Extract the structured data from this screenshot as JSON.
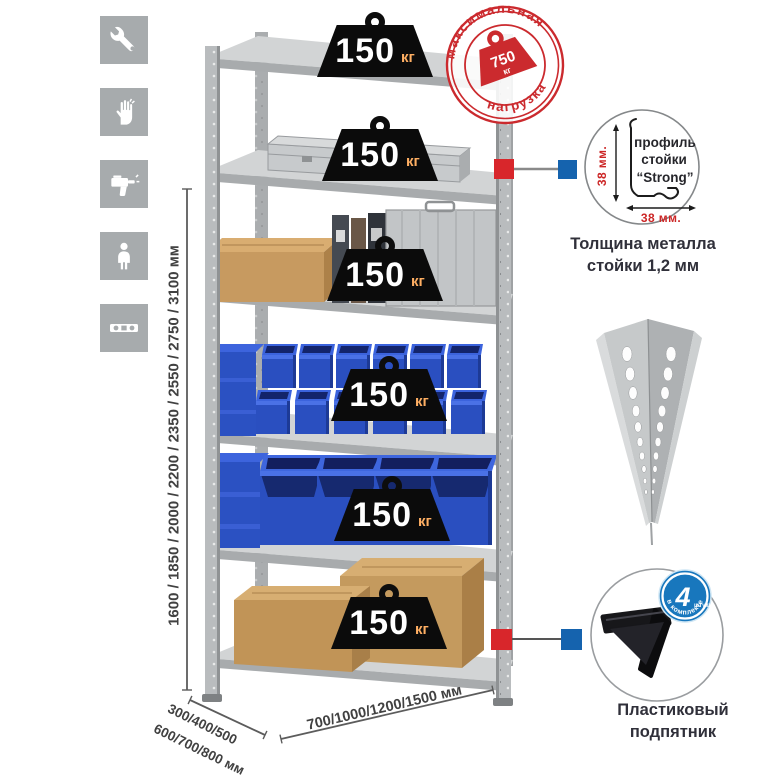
{
  "colors": {
    "stamp_red": "#cb2a2e",
    "connector_red": "#d8262b",
    "connector_blue": "#1563ae",
    "badge_blue": "#1877bd",
    "bin_blue": "#2a4fc0",
    "metal_grey": "#b9bcbe",
    "icon_grey": "#a7abad",
    "weight_black": "#0b0b0b"
  },
  "sidebar": {
    "icons": [
      {
        "name": "wrench-icon"
      },
      {
        "name": "gloves-icon"
      },
      {
        "name": "drill-icon"
      },
      {
        "name": "person-icon"
      },
      {
        "name": "level-icon"
      }
    ]
  },
  "rack": {
    "weights": {
      "unit": "кг",
      "items": [
        "150",
        "150",
        "150",
        "150",
        "150",
        "150"
      ]
    },
    "stamp": {
      "arc_top": "максимальная",
      "arc_bottom": "нагрузка",
      "value": "750",
      "unit": "кг"
    }
  },
  "dimensions": {
    "heights": "1600 / 1850 / 2000 / 2200 / 2350 / 2550 / 2750 / 3100 мм",
    "depth_line1": "300/400/500",
    "depth_line2": "600/700/800 мм",
    "width": "700/1000/1200/1500 мм"
  },
  "details": {
    "profile": {
      "dim_v": "38 мм.",
      "dim_h": "38 мм.",
      "label_line1": "профиль",
      "label_line2": "стойки",
      "label_line3": "“Strong”",
      "caption_line1": "Толщина металла",
      "caption_line2": "стойки 1,2 мм"
    },
    "foot": {
      "badge_value": "4",
      "badge_unit": "штуки",
      "badge_arc": "в комплекте",
      "caption_line1": "Пластиковый",
      "caption_line2": "подпятник"
    }
  }
}
